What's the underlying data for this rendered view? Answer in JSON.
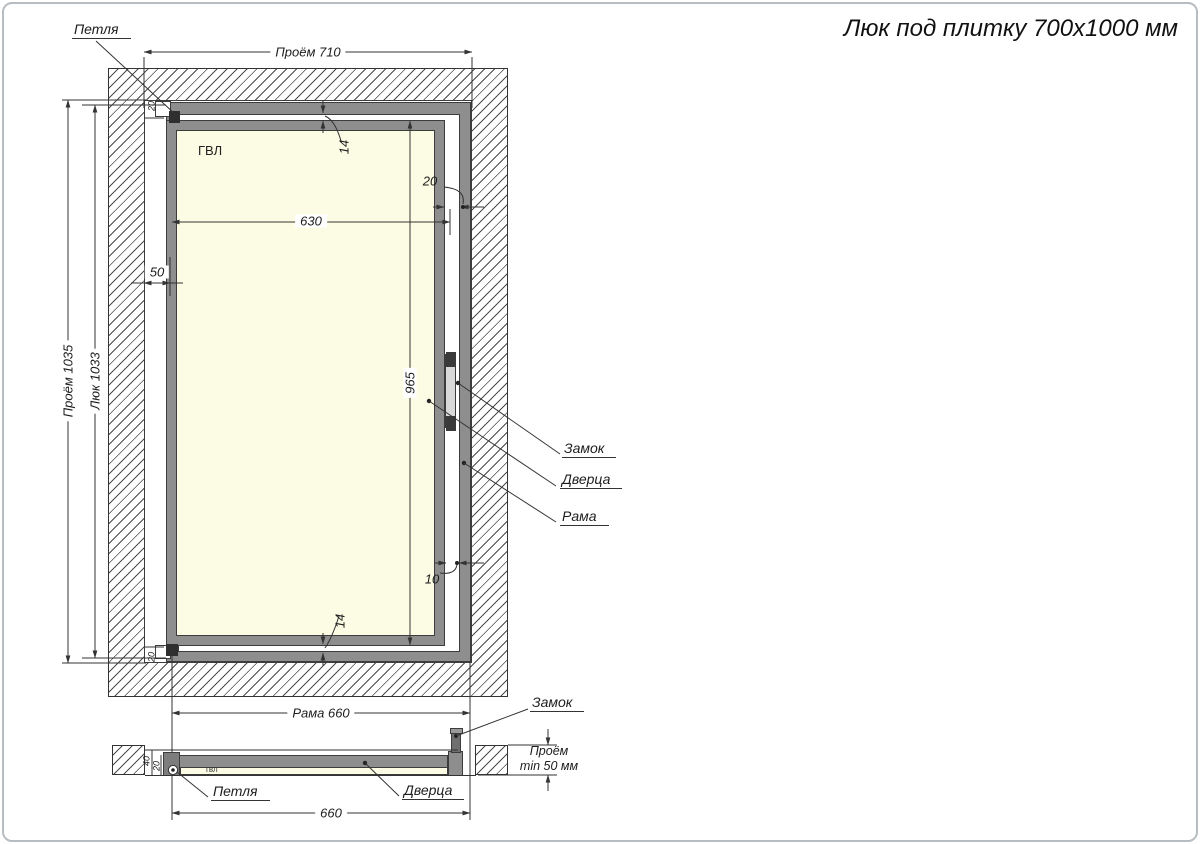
{
  "title": "Люк под плитку 700х1000 мм",
  "front": {
    "opening_width_label": "Проём 710",
    "opening_height_label": "Проём 1035",
    "hatch_height_label": "Люк 1033",
    "panel_width": "630",
    "left_gap": "50",
    "door_height": "965",
    "top_gap": "14",
    "bottom_gap": "14",
    "right_gap": "20",
    "lock_gap": "10",
    "corner_gap_top": "20",
    "corner_gap_bottom": "20",
    "frame_width_label": "Рама 660",
    "hinge_label": "Петля",
    "lock_label": "Замок",
    "door_label": "Дверца",
    "frame_label": "Рама",
    "panel_material": "ГВЛ"
  },
  "section": {
    "width": "660",
    "opening_note_line1": "Проём",
    "opening_note_line2": "min 50 мм",
    "depth": "40",
    "door_thickness": "20",
    "hinge_label": "Петля",
    "lock_label": "Замок",
    "door_label": "Дверца",
    "panel_material": "гвл"
  },
  "colors": {
    "frame_gray": "#8e8e8e",
    "panel_cream": "#fcfce4",
    "line": "#333333"
  }
}
